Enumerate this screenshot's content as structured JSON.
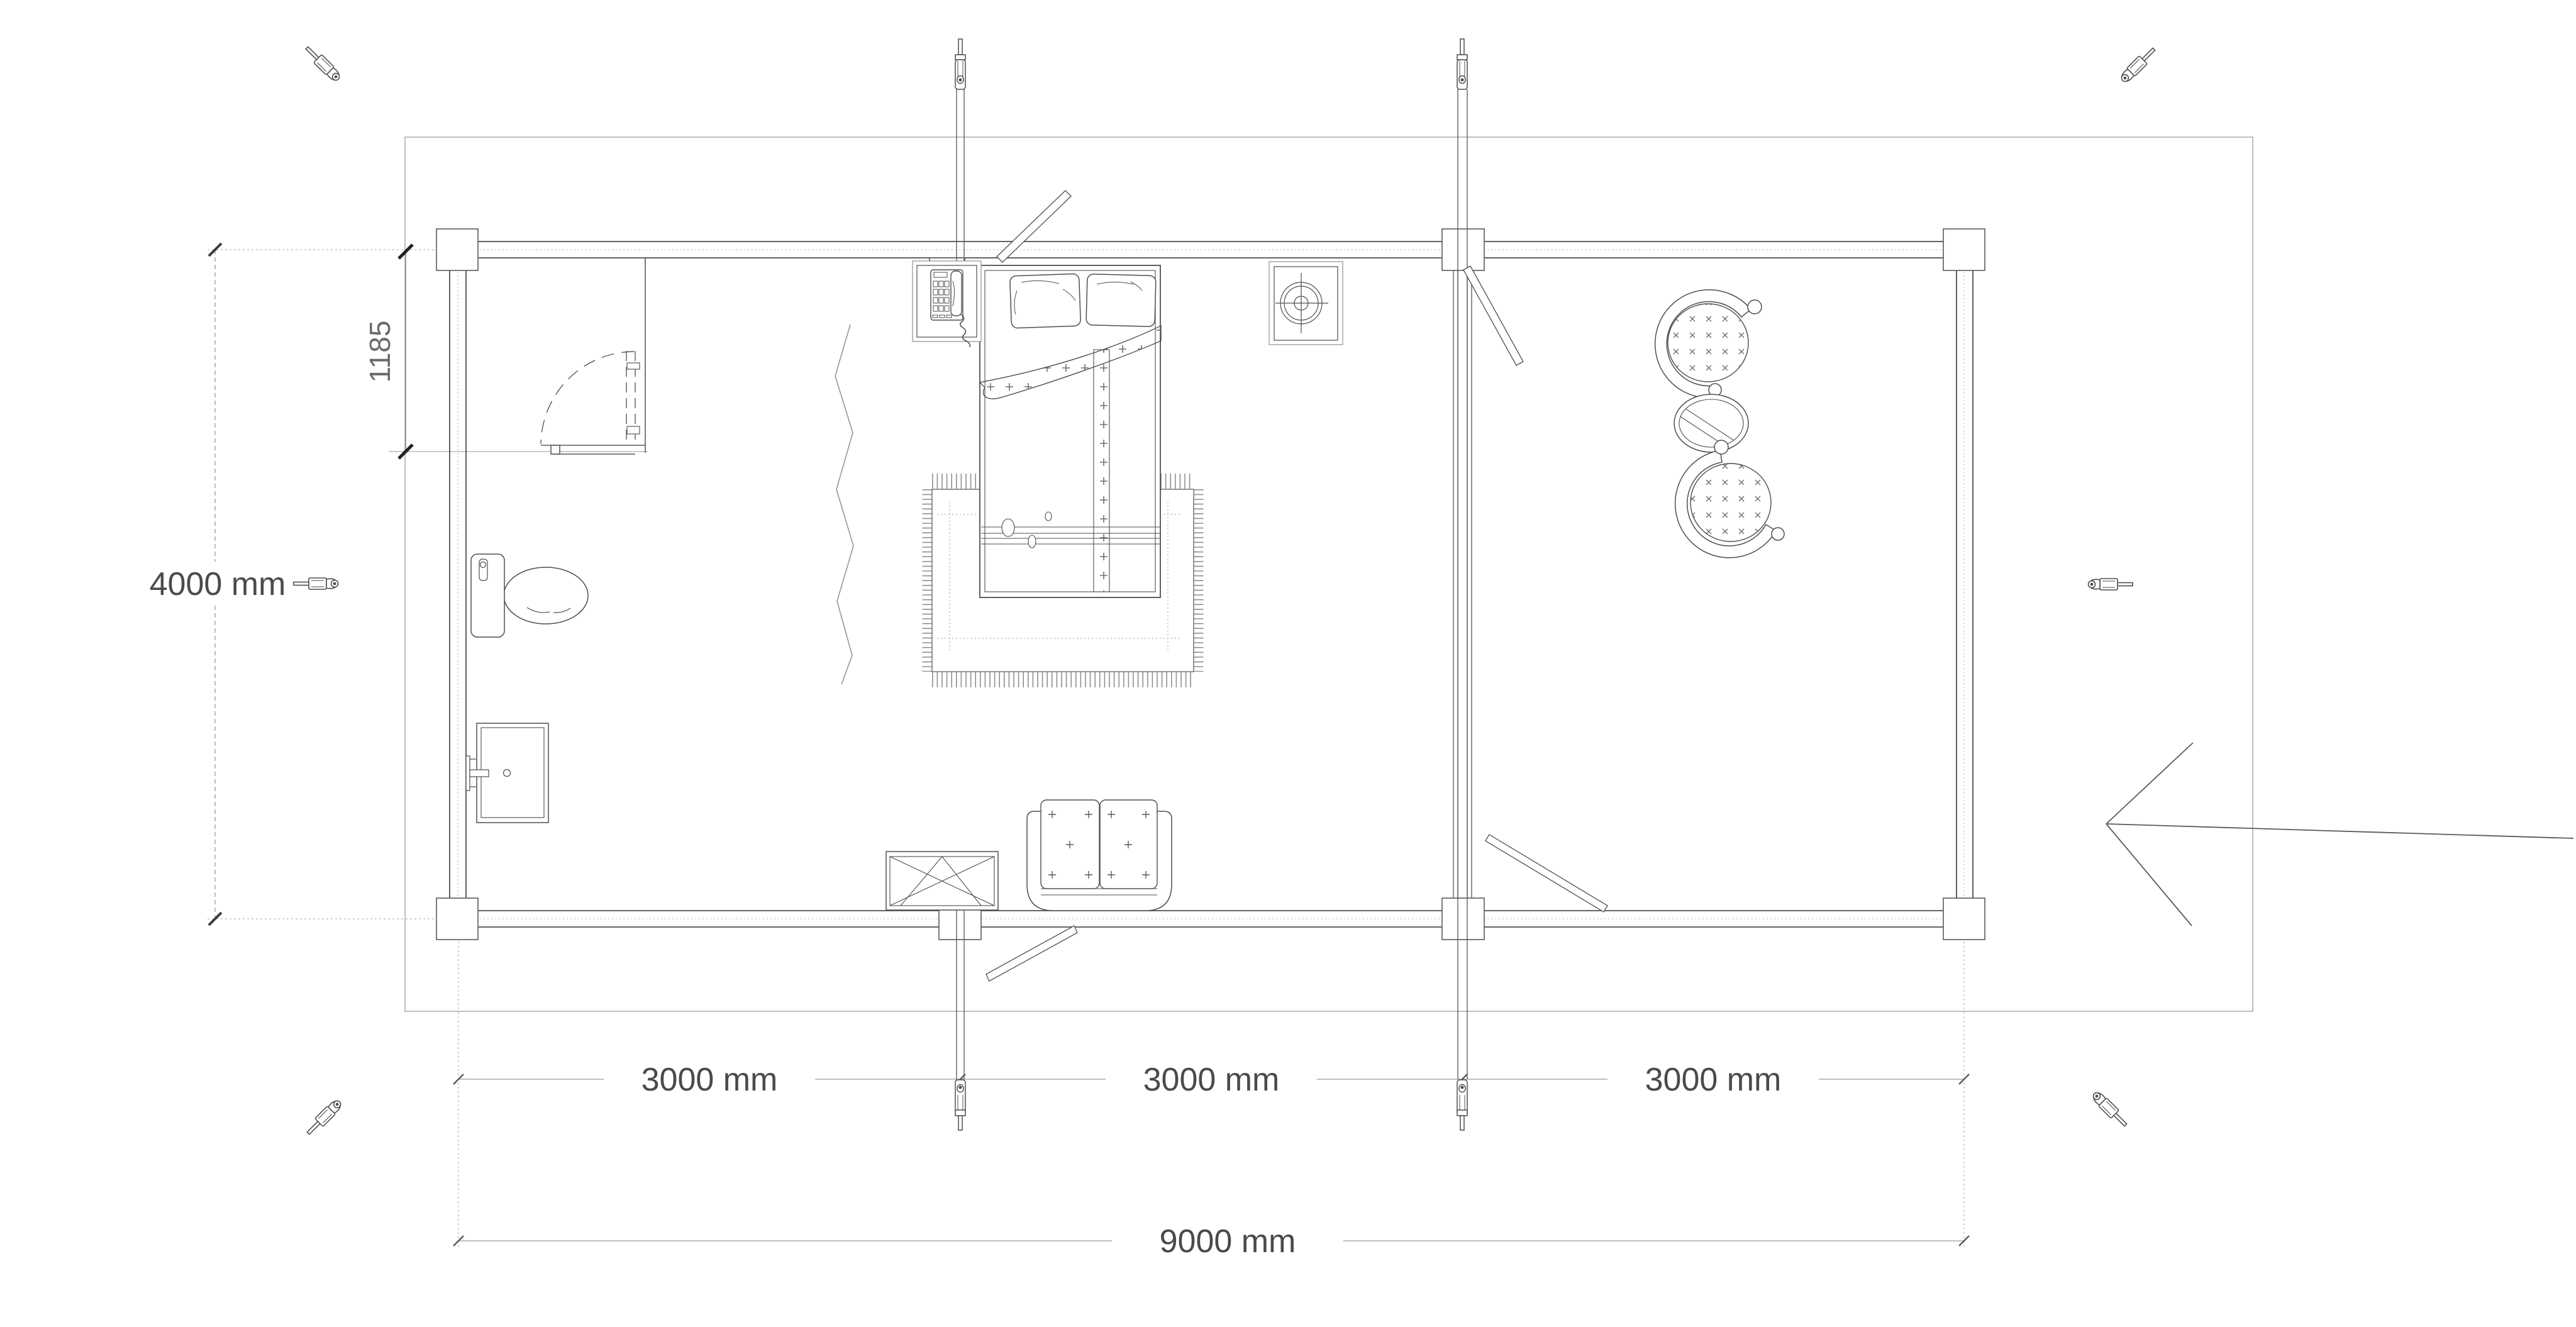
{
  "drawing": {
    "type": "floor-plan",
    "units": "mm"
  },
  "dims": {
    "building_width": "4000 mm",
    "entry_offset": "1185",
    "bay1": "3000 mm",
    "bay2": "3000 mm",
    "bay3": "3000 mm",
    "building_length": "9000 mm"
  },
  "colors": {
    "line": "#4e4e4e",
    "light_line": "#a5a5a5",
    "text": "#4a4a4a",
    "background": "#ffffff"
  },
  "icons": [
    "turnbuckle-icon-top-left",
    "turnbuckle-icon-top-right",
    "turnbuckle-icon-left",
    "turnbuckle-icon-right",
    "turnbuckle-icon-bottom-left",
    "turnbuckle-icon-bottom-right",
    "tie-rod-bolt-icon-x4",
    "entrance-arrow-icon"
  ]
}
